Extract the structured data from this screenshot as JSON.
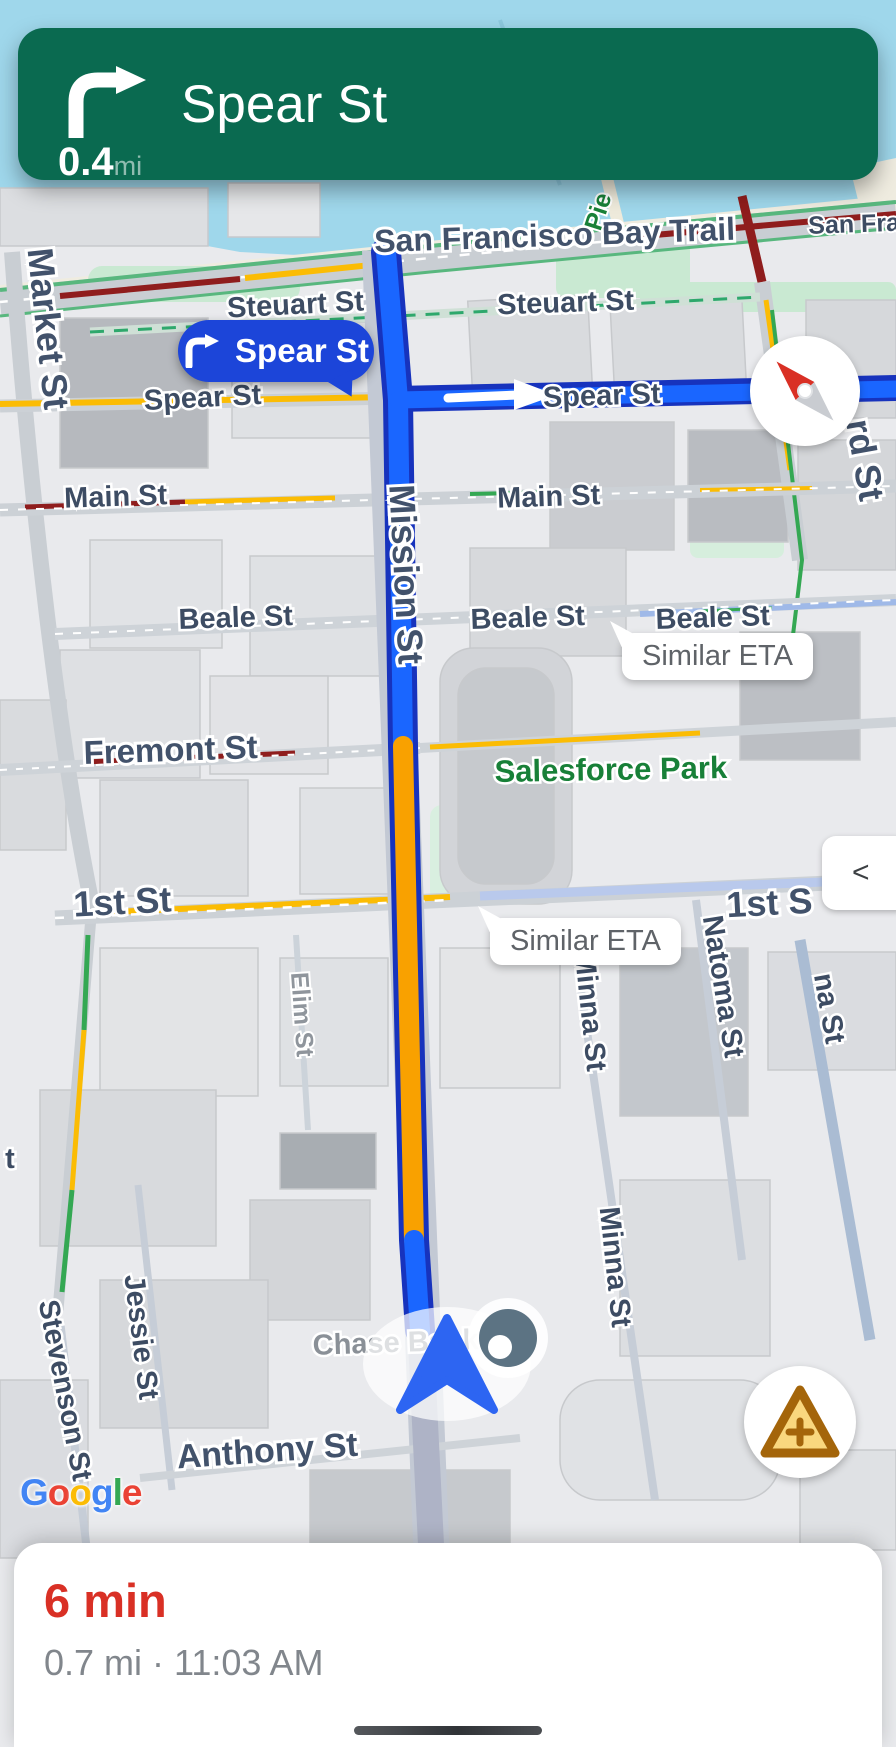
{
  "banner": {
    "maneuver_icon": "turn-right",
    "street": "Spear St",
    "distance": "0.4",
    "distance_unit": "mi"
  },
  "turn_callout": {
    "text": "Spear St"
  },
  "eta_callouts": {
    "beale": "Similar ETA",
    "first": "Similar ETA"
  },
  "controls": {
    "collapse": "<"
  },
  "logo": {
    "letters": [
      "G",
      "o",
      "o",
      "g",
      "l",
      "e"
    ]
  },
  "sheet": {
    "eta": "6 min",
    "details": "0.7 mi · 11:03 AM"
  },
  "map_labels": {
    "bay_trail": "San Francisco Bay Trail",
    "san_fran_partial": "San Fran",
    "pier_partial": "Pie",
    "market": "Market St",
    "steuart_1": "Steuart St",
    "steuart_2": "Steuart St",
    "spear_left": "Spear St",
    "spear_right": "Spear St",
    "howard_partial": "rd St",
    "main_1": "Main St",
    "main_2": "Main St",
    "beale_1": "Beale St",
    "beale_2": "Beale St",
    "beale_3": "Beale St",
    "fremont": "Fremont St",
    "salesforce_park": "Salesforce Park",
    "first_left": "1st St",
    "first_right_partial": "1st S",
    "mission": "Mission St",
    "natoma": "Natoma St",
    "minna_1": "Minna St",
    "minna_2": "Minna St",
    "minna_partial": "na St",
    "elim": "Elim St",
    "jessie": "Jessie St",
    "stevenson": "Stevenson St",
    "t_partial": "t",
    "chase_bank": "Chase Bank",
    "anthony": "Anthony St"
  },
  "colors": {
    "banner_green": "#0a6a50",
    "route_blue": "#1a66ff",
    "route_border": "#1733bd",
    "traffic_orange": "#f9a100",
    "traffic_red": "#8f1d1d",
    "traffic_yellow": "#fbbc04",
    "water": "#9fd7eb",
    "eta_red": "#d93025",
    "callout_blue": "#1c45d9",
    "google_blue": "#4285F4",
    "google_red": "#EA4335",
    "google_yellow": "#FBBC05",
    "google_green": "#34A853"
  }
}
